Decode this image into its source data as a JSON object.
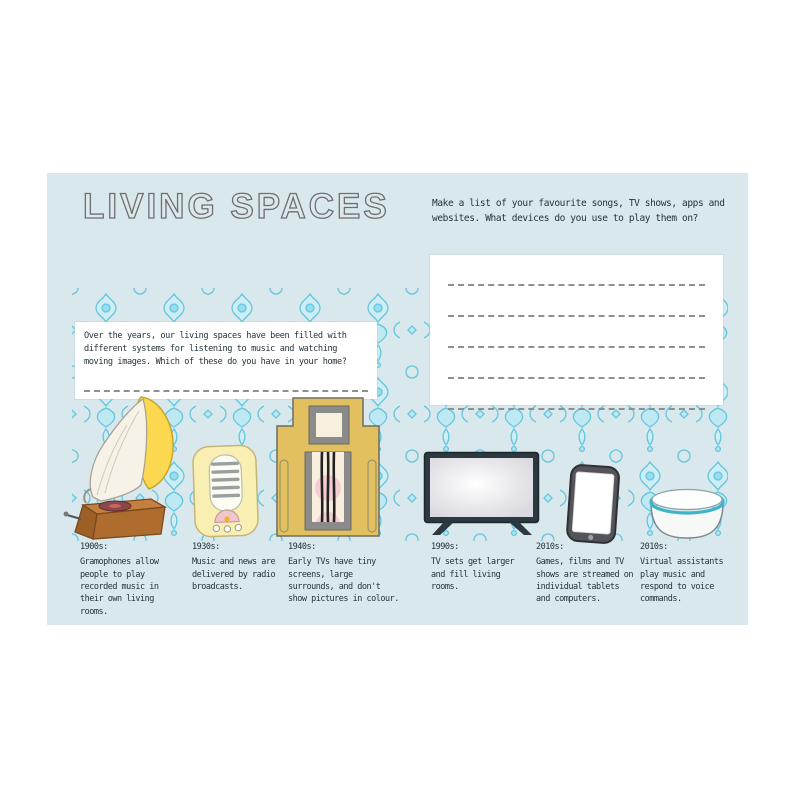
{
  "page": {
    "title": "LIVING SPACES",
    "background_color": "#d9e8ed",
    "pattern_color": "#55c2dc",
    "text_color": "#24333c"
  },
  "activity": {
    "prompt_lines": [
      "Make a list of your favourite songs, TV shows, apps and",
      "websites. What devices do you use to play them on?"
    ],
    "answer_lines_count": 5
  },
  "intro": {
    "lines": [
      "Over the years, our living spaces have been filled with",
      "different systems for listening to music and watching",
      "moving images. Which of these do you have in your home?"
    ]
  },
  "timeline": [
    {
      "decade": "1900s:",
      "caption": "Gramophones allow people to play recorded music in their own living rooms.",
      "icon": "gramophone-icon"
    },
    {
      "decade": "1930s:",
      "caption": "Music and news are delivered by radio broadcasts.",
      "icon": "radio-icon"
    },
    {
      "decade": "1940s:",
      "caption": "Early TVs have tiny screens, large surrounds, and don't show pictures in colour.",
      "icon": "early-tv-icon"
    },
    {
      "decade": "1990s:",
      "caption": "TV sets get larger and fill living rooms.",
      "icon": "flat-tv-icon"
    },
    {
      "decade": "2010s:",
      "caption": "Games, films and TV shows are streamed on individual tablets and computers.",
      "icon": "tablet-icon"
    },
    {
      "decade": "2010s:",
      "caption": "Virtual assistants play music and respond to voice commands.",
      "icon": "voice-assistant-icon"
    }
  ]
}
